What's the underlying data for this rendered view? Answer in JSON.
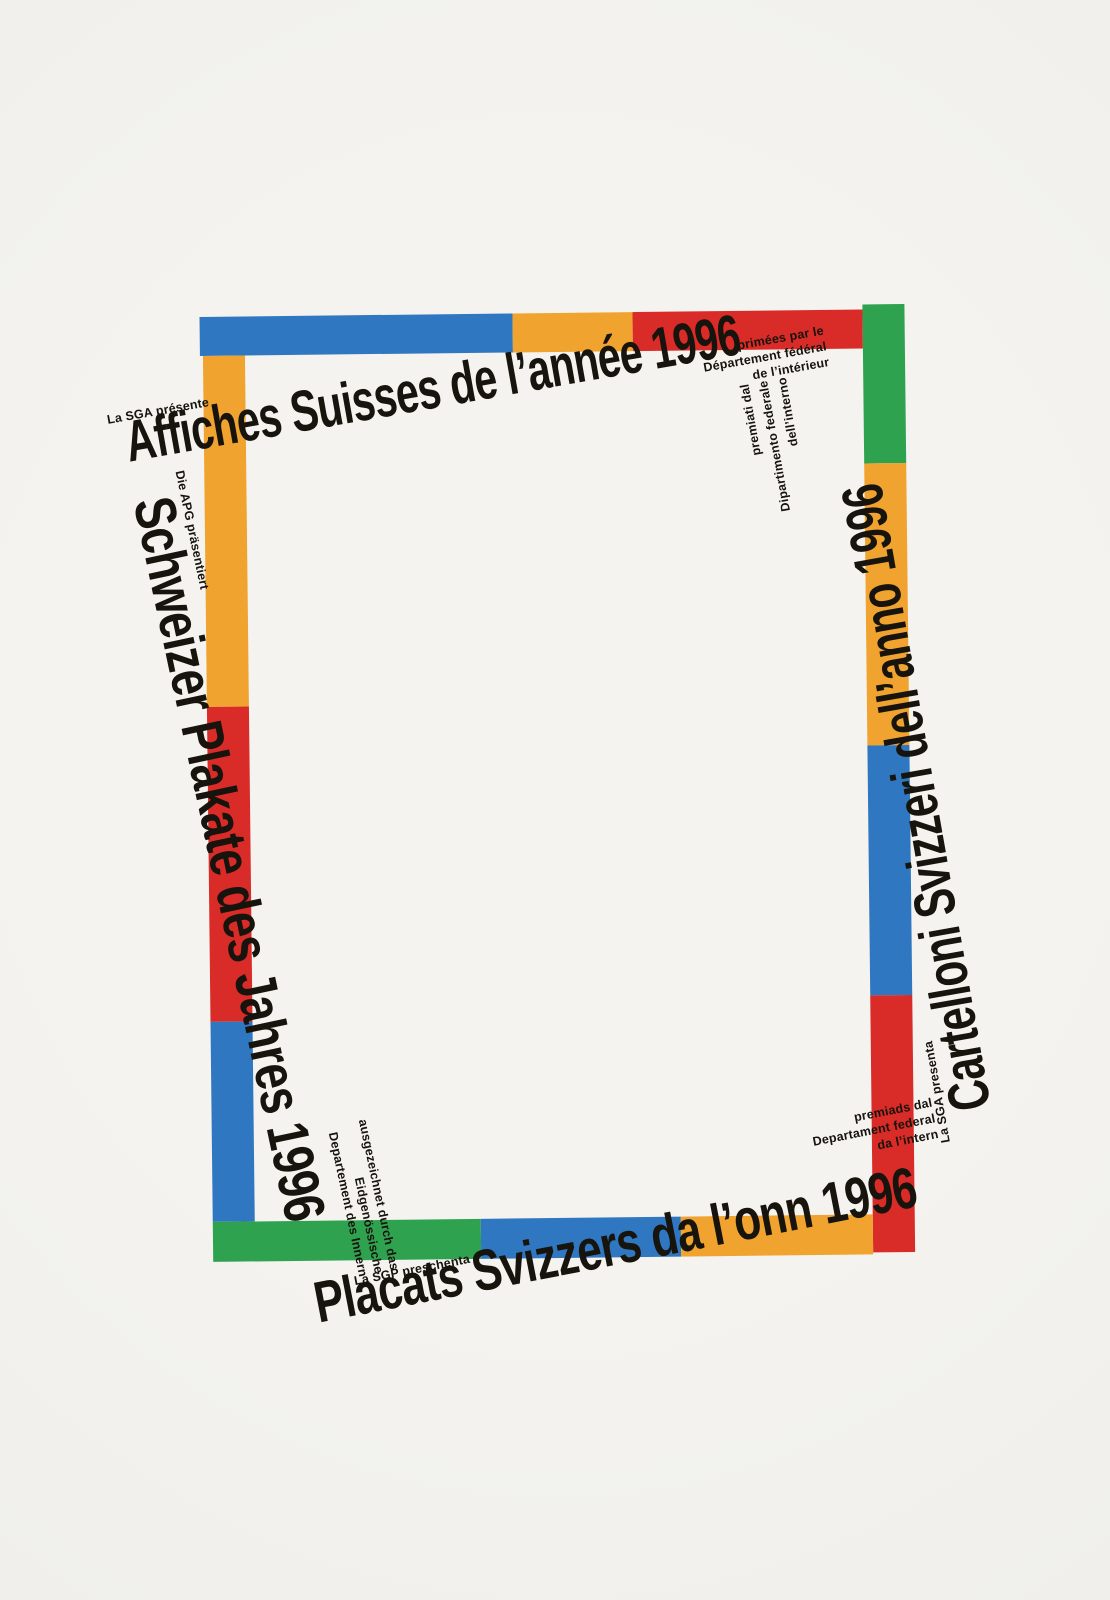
{
  "palette": {
    "blue": "#2f77c0",
    "orange": "#f0a32f",
    "red": "#d92b27",
    "green": "#2fa24f",
    "paper": "#f2f1ed",
    "ink": "#17130d"
  },
  "frame": {
    "top_segments": [
      "blue",
      "orange",
      "red"
    ],
    "right_segments": [
      "green",
      "orange",
      "blue",
      "red"
    ],
    "left_segments": [
      "orange",
      "red",
      "blue"
    ],
    "bottom_segments": [
      "green",
      "blue",
      "orange"
    ]
  },
  "edges": {
    "top": {
      "language": "french",
      "presenter": "La SGA présente",
      "title": "Affiches Suisses de l’année 1996",
      "award_lines": [
        "primées par le",
        "Département fédéral",
        "de l’intérieur"
      ]
    },
    "left": {
      "language": "german",
      "presenter": "Die APG präsentiert",
      "title": "Schweizer Plakate des Jahres 1996",
      "award_lines": [
        "ausgezeichnet durch das",
        "Eidgenössische",
        "Departement des Innern"
      ]
    },
    "right": {
      "language": "italian",
      "presenter": "La SGA presenta",
      "title": "Cartelloni Svizzeri dell’anno 1996",
      "award_lines": [
        "premiati dal",
        "Dipartimento federale",
        "dell’interno"
      ]
    },
    "bottom": {
      "language": "romansh",
      "presenter": "La SGP preschenta",
      "title": "Placats Svizzers da l’onn 1996",
      "award_lines": [
        "premiads dal",
        "Departament federal",
        "da l’intern"
      ]
    }
  }
}
